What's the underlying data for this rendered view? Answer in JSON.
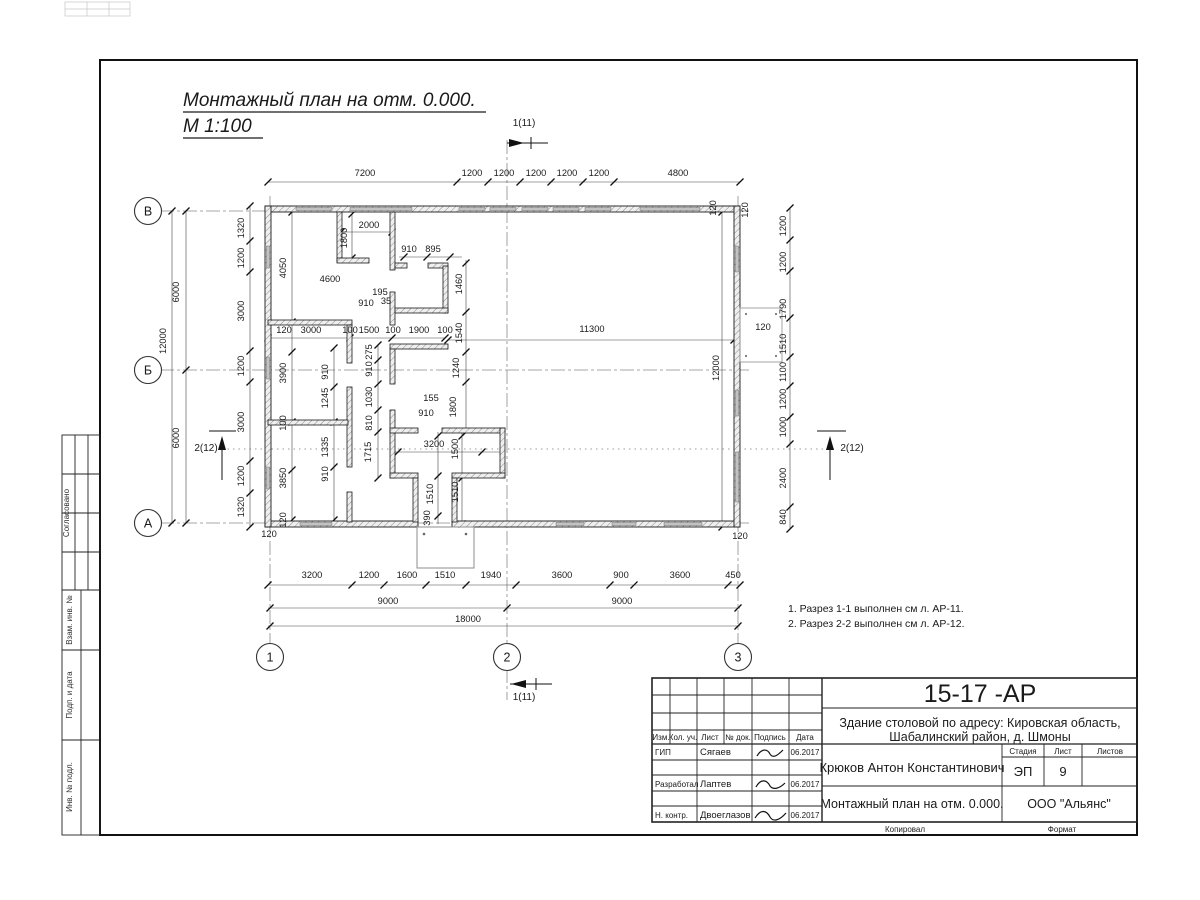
{
  "page": {
    "title_line1": "Монтажный план на отм. 0.000.",
    "title_line2": "М 1:100",
    "notes": [
      "1. Разрез 1-1 выполнен см л. АР-11.",
      "2. Разрез 2-2 выполнен см л. АР-12."
    ]
  },
  "side_column": {
    "agreed": "Согласовано",
    "vzam_inv": "Взам. инв. №",
    "podp_data": "Подп. и дата",
    "inv_podl": "Инв. № подл."
  },
  "title_block": {
    "doc_number": "15-17 -АР",
    "project_line1": "Здание столовой по адресу: Кировская область,",
    "project_line2": "Шабалинский район, д. Шмоны",
    "header_cols": [
      "Изм.",
      "Кол. уч.",
      "Лист",
      "№ док.",
      "Подпись",
      "Дата"
    ],
    "rows": [
      {
        "role": "ГИП",
        "name": "Сягаев",
        "date": "06.2017"
      },
      {
        "role": "Разработал",
        "name": "Лаптев",
        "date": "06.2017"
      },
      {
        "role": "Н. контр.",
        "name": "Двоеглазов",
        "date": "06.2017"
      }
    ],
    "author": "Крюков Антон Константинович",
    "stage_label": "Стадия",
    "sheet_label": "Лист",
    "sheets_label": "Листов",
    "stage": "ЭП",
    "sheet_number": "9",
    "drawing_title": "Монтажный план на отм. 0.000.",
    "company": "ООО \"Альянс\"",
    "copied_label": "Копировал",
    "format_label": "Формат"
  },
  "plan": {
    "axes": [
      {
        "label": "В",
        "x": 148,
        "y": 211
      },
      {
        "label": "Б",
        "x": 148,
        "y": 370
      },
      {
        "label": "А",
        "x": 148,
        "y": 523
      },
      {
        "label": "1",
        "x": 270,
        "y": 657
      },
      {
        "label": "2",
        "x": 507,
        "y": 657
      },
      {
        "label": "3",
        "x": 738,
        "y": 657
      }
    ],
    "section_markers": [
      {
        "label": "1(11)",
        "x": 524,
        "y": 126
      },
      {
        "label": "1(11)",
        "x": 524,
        "y": 700
      },
      {
        "label": "2(12)",
        "x": 206,
        "y": 451
      },
      {
        "label": "2(12)",
        "x": 852,
        "y": 451
      }
    ],
    "dims": [
      {
        "t": "7200",
        "x": 365,
        "y": 176
      },
      {
        "t": "1200",
        "x": 472,
        "y": 176
      },
      {
        "t": "1200",
        "x": 504,
        "y": 176
      },
      {
        "t": "1200",
        "x": 536,
        "y": 176
      },
      {
        "t": "1200",
        "x": 567,
        "y": 176
      },
      {
        "t": "1200",
        "x": 599,
        "y": 176
      },
      {
        "t": "4800",
        "x": 678,
        "y": 176
      },
      {
        "t": "120",
        "x": 716,
        "y": 208,
        "r": -90
      },
      {
        "t": "120",
        "x": 748,
        "y": 210,
        "r": -90
      },
      {
        "t": "1200",
        "x": 786,
        "y": 226,
        "r": -90
      },
      {
        "t": "1200",
        "x": 786,
        "y": 262,
        "r": -90
      },
      {
        "t": "1790",
        "x": 786,
        "y": 309,
        "r": -90
      },
      {
        "t": "1510",
        "x": 786,
        "y": 344,
        "r": -90
      },
      {
        "t": "1100",
        "x": 786,
        "y": 372,
        "r": -90
      },
      {
        "t": "1200",
        "x": 786,
        "y": 399,
        "r": -90
      },
      {
        "t": "1000",
        "x": 786,
        "y": 427,
        "r": -90
      },
      {
        "t": "2400",
        "x": 786,
        "y": 478,
        "r": -90
      },
      {
        "t": "840",
        "x": 786,
        "y": 517,
        "r": -90
      },
      {
        "t": "120",
        "x": 763,
        "y": 330
      },
      {
        "t": "12000",
        "x": 719,
        "y": 368,
        "r": -90
      },
      {
        "t": "120",
        "x": 740,
        "y": 539
      },
      {
        "t": "1320",
        "x": 244,
        "y": 228,
        "r": -90
      },
      {
        "t": "1200",
        "x": 244,
        "y": 258,
        "r": -90
      },
      {
        "t": "3000",
        "x": 244,
        "y": 311,
        "r": -90
      },
      {
        "t": "1200",
        "x": 244,
        "y": 366,
        "r": -90
      },
      {
        "t": "3000",
        "x": 244,
        "y": 422,
        "r": -90
      },
      {
        "t": "1200",
        "x": 244,
        "y": 476,
        "r": -90
      },
      {
        "t": "1320",
        "x": 244,
        "y": 507,
        "r": -90
      },
      {
        "t": "6000",
        "x": 179,
        "y": 292,
        "r": -90
      },
      {
        "t": "12000",
        "x": 166,
        "y": 341,
        "r": -90
      },
      {
        "t": "6000",
        "x": 179,
        "y": 438,
        "r": -90
      },
      {
        "t": "3200",
        "x": 312,
        "y": 578
      },
      {
        "t": "1200",
        "x": 369,
        "y": 578
      },
      {
        "t": "1600",
        "x": 407,
        "y": 578
      },
      {
        "t": "1510",
        "x": 445,
        "y": 578
      },
      {
        "t": "1940",
        "x": 491,
        "y": 578
      },
      {
        "t": "3600",
        "x": 562,
        "y": 578
      },
      {
        "t": "900",
        "x": 621,
        "y": 578
      },
      {
        "t": "3600",
        "x": 680,
        "y": 578
      },
      {
        "t": "450",
        "x": 733,
        "y": 578
      },
      {
        "t": "9000",
        "x": 388,
        "y": 604
      },
      {
        "t": "9000",
        "x": 622,
        "y": 604
      },
      {
        "t": "18000",
        "x": 468,
        "y": 622
      },
      {
        "t": "120",
        "x": 269,
        "y": 537
      },
      {
        "t": "2000",
        "x": 369,
        "y": 228
      },
      {
        "t": "1800",
        "x": 347,
        "y": 238,
        "r": -90
      },
      {
        "t": "4050",
        "x": 286,
        "y": 268,
        "r": -90
      },
      {
        "t": "4600",
        "x": 330,
        "y": 282
      },
      {
        "t": "910",
        "x": 409,
        "y": 252
      },
      {
        "t": "895",
        "x": 433,
        "y": 252
      },
      {
        "t": "1460",
        "x": 462,
        "y": 284,
        "r": -90
      },
      {
        "t": "195",
        "x": 380,
        "y": 295
      },
      {
        "t": "910",
        "x": 366,
        "y": 306
      },
      {
        "t": "35",
        "x": 386,
        "y": 304
      },
      {
        "t": "120",
        "x": 284,
        "y": 333
      },
      {
        "t": "3000",
        "x": 311,
        "y": 333
      },
      {
        "t": "100",
        "x": 350,
        "y": 333
      },
      {
        "t": "1500",
        "x": 369,
        "y": 333
      },
      {
        "t": "100",
        "x": 393,
        "y": 333
      },
      {
        "t": "1900",
        "x": 419,
        "y": 333
      },
      {
        "t": "100",
        "x": 445,
        "y": 333
      },
      {
        "t": "1540",
        "x": 462,
        "y": 333,
        "r": -90
      },
      {
        "t": "11300",
        "x": 592,
        "y": 332
      },
      {
        "t": "3900",
        "x": 286,
        "y": 373,
        "r": -90
      },
      {
        "t": "910",
        "x": 328,
        "y": 372,
        "r": -90
      },
      {
        "t": "1245",
        "x": 328,
        "y": 398,
        "r": -90
      },
      {
        "t": "100",
        "x": 286,
        "y": 423,
        "r": -90
      },
      {
        "t": "1335",
        "x": 328,
        "y": 447,
        "r": -90
      },
      {
        "t": "3850",
        "x": 286,
        "y": 478,
        "r": -90
      },
      {
        "t": "910",
        "x": 328,
        "y": 474,
        "r": -90
      },
      {
        "t": "120",
        "x": 286,
        "y": 520,
        "r": -90
      },
      {
        "t": "275",
        "x": 372,
        "y": 352,
        "r": -90
      },
      {
        "t": "910",
        "x": 372,
        "y": 369,
        "r": -90
      },
      {
        "t": "1030",
        "x": 372,
        "y": 397,
        "r": -90
      },
      {
        "t": "810",
        "x": 372,
        "y": 423,
        "r": -90
      },
      {
        "t": "1715",
        "x": 371,
        "y": 452,
        "r": -90
      },
      {
        "t": "1240",
        "x": 459,
        "y": 368,
        "r": -90
      },
      {
        "t": "155",
        "x": 431,
        "y": 401
      },
      {
        "t": "910",
        "x": 426,
        "y": 416
      },
      {
        "t": "1800",
        "x": 456,
        "y": 407,
        "r": -90
      },
      {
        "t": "3200",
        "x": 434,
        "y": 447
      },
      {
        "t": "1500",
        "x": 458,
        "y": 449,
        "r": -90
      },
      {
        "t": "1510",
        "x": 433,
        "y": 494,
        "r": -90
      },
      {
        "t": "1510",
        "x": 458,
        "y": 492,
        "r": -90
      },
      {
        "t": "390",
        "x": 430,
        "y": 518,
        "r": -90
      }
    ]
  }
}
